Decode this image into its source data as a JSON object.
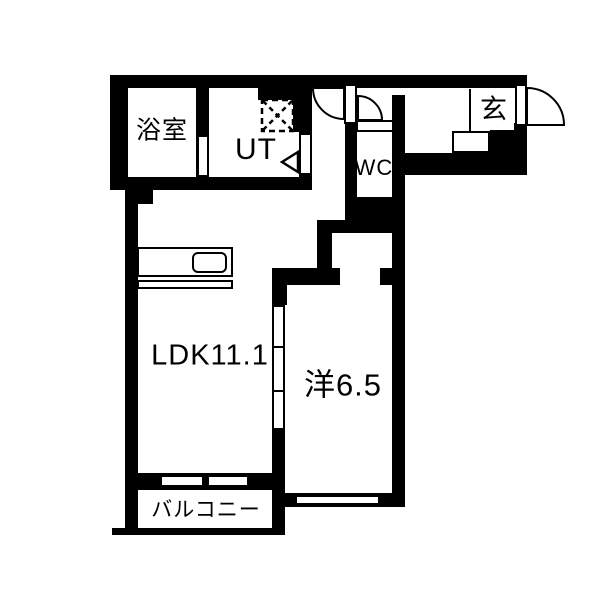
{
  "floorplan": {
    "title": "1LDK apartment floor plan",
    "labels": {
      "bathroom": "浴室",
      "utility": "UT",
      "toilet": "WC",
      "entrance": "玄",
      "ldk": "LDK11.1",
      "western_room": "洋6.5",
      "balcony": "バルコニー"
    },
    "rooms": [
      {
        "id": "bathroom",
        "label": "浴室"
      },
      {
        "id": "utility",
        "label": "UT"
      },
      {
        "id": "toilet",
        "label": "WC"
      },
      {
        "id": "entrance",
        "label": "玄"
      },
      {
        "id": "living-dining-kitchen",
        "label": "LDK11.1"
      },
      {
        "id": "western-room",
        "label": "洋6.5"
      },
      {
        "id": "balcony",
        "label": "バルコニー"
      }
    ],
    "symbols": {
      "entrance_door": "swing-door-arc",
      "hall_door": "swing-door-arc",
      "wc_door": "swing-door-arc",
      "ut_door_marker": "triangle-door-marker",
      "washer_space": "washing-machine-dashed-square",
      "ldk_partition": "sliding-door-3-panel",
      "balcony_opening": "sliding-window-2-panel",
      "western_room_window": "window",
      "kitchen": "kitchen-counter-with-sink",
      "entrance_step": "genkan-step"
    },
    "colors": {
      "wall": "#000000",
      "floor": "#ffffff"
    }
  }
}
